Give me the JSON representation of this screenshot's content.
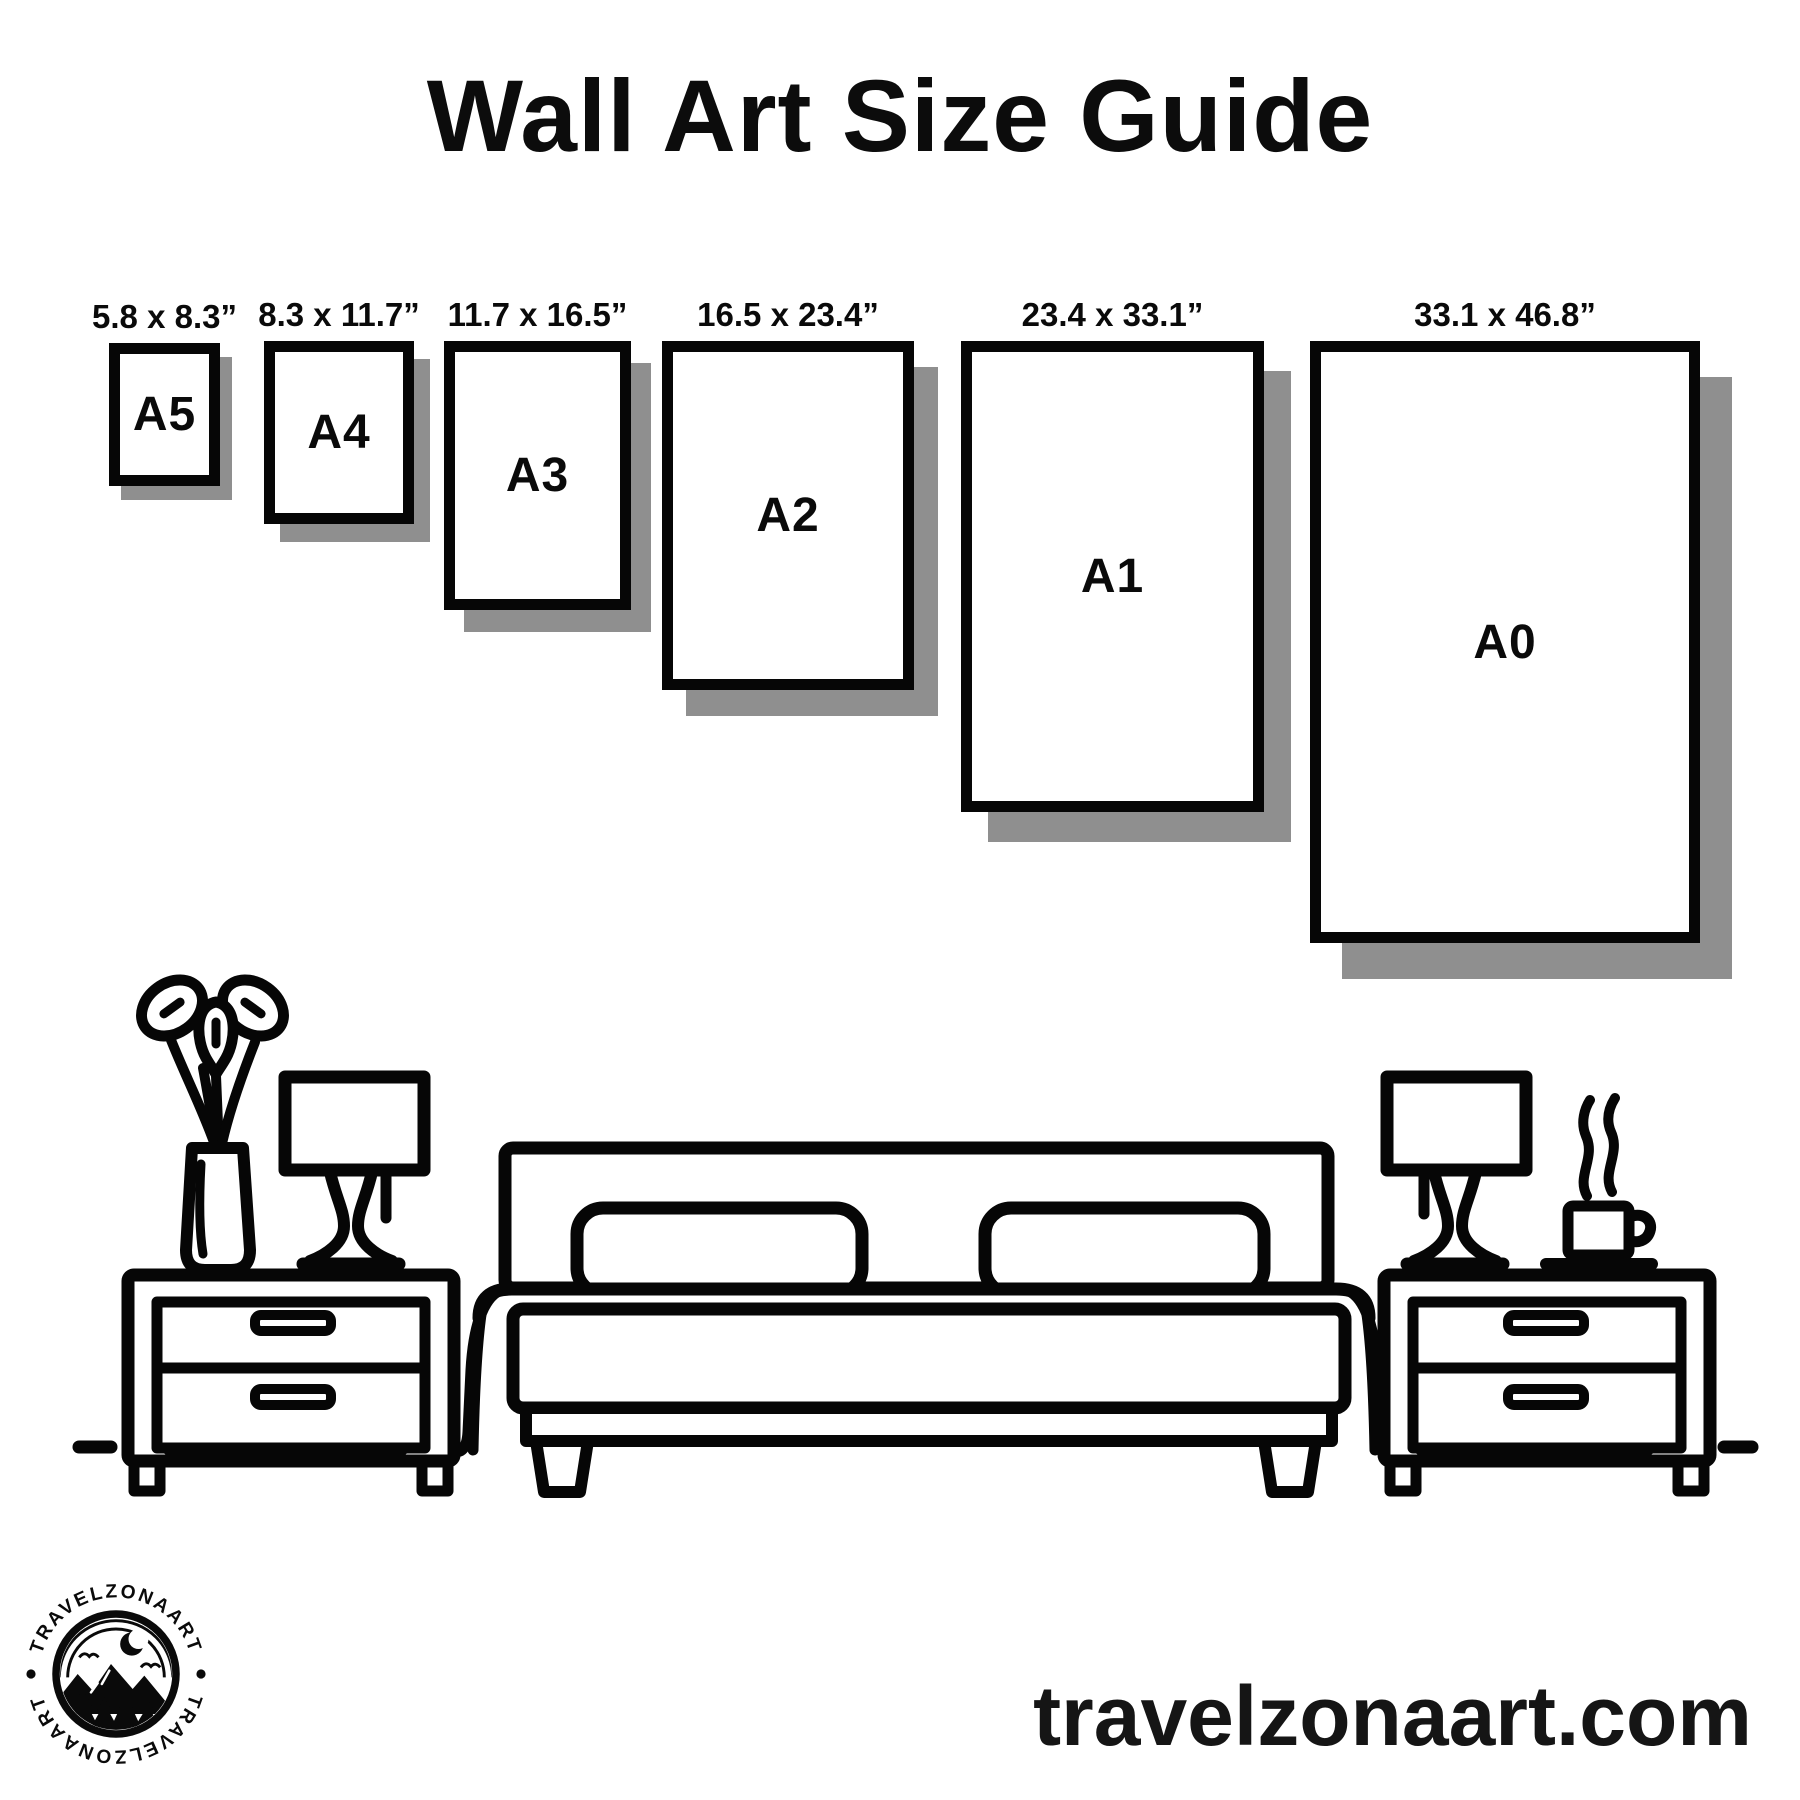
{
  "title": "Wall Art Size Guide",
  "sizes": [
    {
      "label": "A5",
      "dimensions": "5.8 x 8.3”"
    },
    {
      "label": "A4",
      "dimensions": "8.3 x 11.7”"
    },
    {
      "label": "A3",
      "dimensions": "11.7 x 16.5”"
    },
    {
      "label": "A2",
      "dimensions": "16.5 x 23.4”"
    },
    {
      "label": "A1",
      "dimensions": "23.4 x 33.1”"
    },
    {
      "label": "A0",
      "dimensions": "33.1 x 46.8”"
    }
  ],
  "footer": {
    "website": "travelzonaart.com"
  },
  "logo": {
    "brand_top": "TRAVELZONAART",
    "brand_bottom": "TRAVELZONAART"
  },
  "colors": {
    "ink": "#0a0a0a",
    "shadow": "#8f8f8f",
    "background": "#ffffff"
  }
}
